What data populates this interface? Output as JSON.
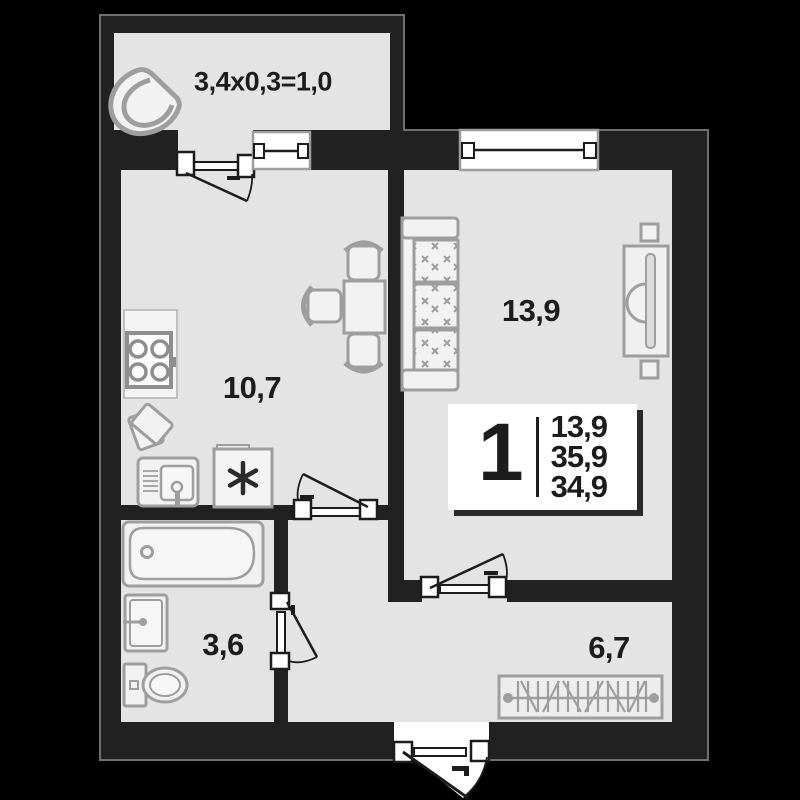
{
  "rooms": {
    "balcony": {
      "label": "3,4x0,3=1,0"
    },
    "kitchen": {
      "label": "10,7"
    },
    "living_room": {
      "label": "13,9"
    },
    "bathroom": {
      "label": "3,6"
    },
    "hallway": {
      "label": "6,7"
    }
  },
  "info_badge": {
    "room_count": "1",
    "areas": [
      "13,9",
      "35,9",
      "34,9"
    ]
  },
  "colors": {
    "background": "#000000",
    "walls": "#212121",
    "wall_outline": "#6f6f6f",
    "floor": "#e4e4e4",
    "furniture_outline": "#9e9e9e",
    "furniture_fill": "#f2f2f2",
    "door_window_lines": "#1c1c1c",
    "badge_background": "#ffffff",
    "text": "#1c1c1c"
  },
  "icons": [
    "armchair-icon",
    "stove-icon",
    "cutting-board-icon",
    "kitchen-sink-icon",
    "fridge-icon",
    "snowflake-icon",
    "dining-table-icon",
    "chair-icon",
    "sofa-icon",
    "tv-stand-icon",
    "speaker-icon",
    "bathtub-icon",
    "washbasin-icon",
    "toilet-icon",
    "wardrobe-icon",
    "door-icon",
    "window-icon",
    "entrance-door-icon"
  ]
}
